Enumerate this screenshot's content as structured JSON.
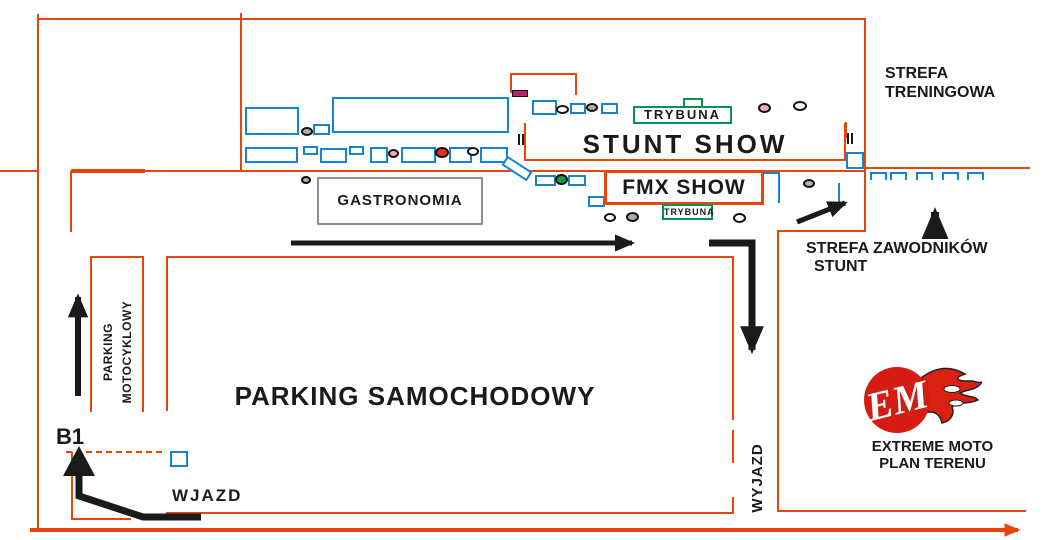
{
  "colors": {
    "boundary_orange": "#e8440c",
    "structure_blue": "#1683d2",
    "grandstand_green": "#00954f",
    "logo_red": "#d41c12"
  },
  "areas": {
    "training_zone": {
      "line1": "STREFA",
      "line2": "TRENINGOWA"
    },
    "stunt_show": {
      "label": "STUNT SHOW"
    },
    "fmx_show": {
      "label": "FMX SHOW"
    },
    "grandstand_upper": {
      "label": "TRYBUNA"
    },
    "grandstand_lower": {
      "label": "TRYBUNA"
    },
    "gastronomy": {
      "label": "GASTRONOMIA"
    },
    "stunt_competitors_zone": {
      "line1": "STREFA ZAWODNIKÓW",
      "line2": "STUNT"
    },
    "car_parking": {
      "label": "PARKING SAMOCHODOWY"
    },
    "motorcycle_parking": {
      "line1": "PARKING",
      "line2": "MOTOCYKLOWY"
    }
  },
  "gates": {
    "entrance_label": "WJAZD",
    "exit_label": "WYJAZD",
    "gate_b1_label": "B1"
  },
  "branding": {
    "monogram": "EM",
    "title_line1": "EXTREME MOTO",
    "title_line2": "PLAN TERENU"
  }
}
